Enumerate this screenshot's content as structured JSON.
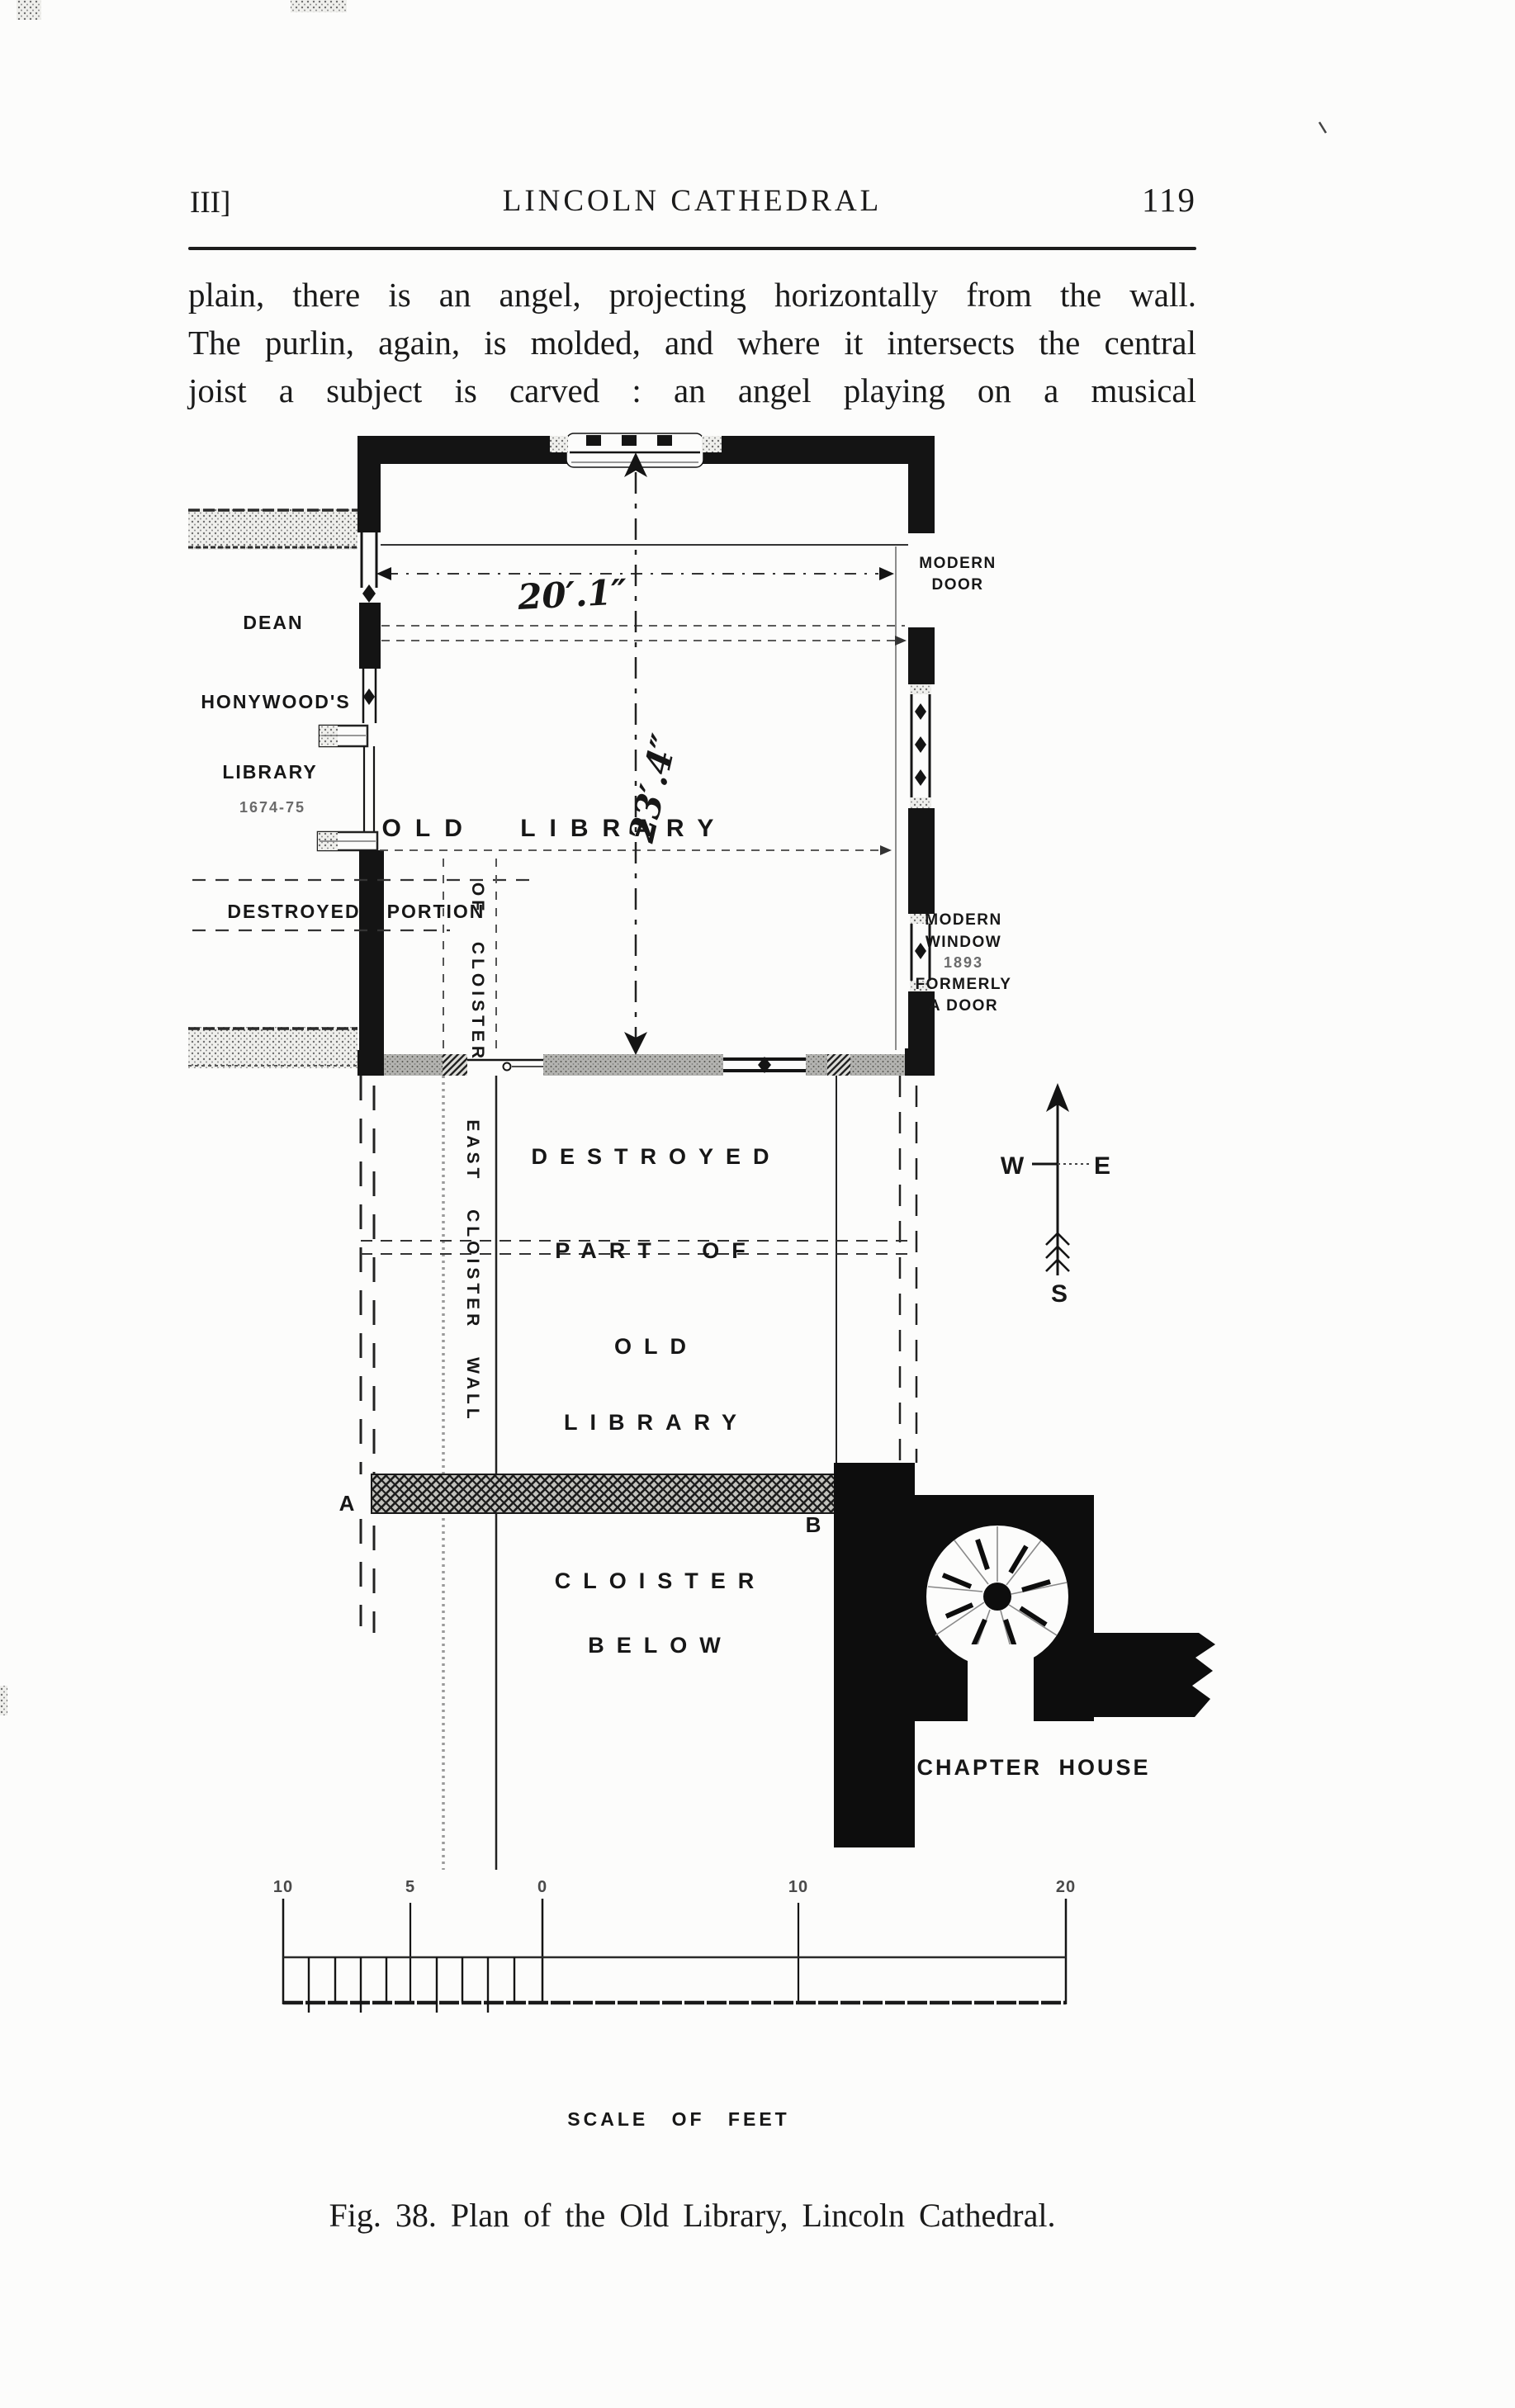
{
  "header": {
    "chapter_marker": "III]",
    "running_title": "LINCOLN CATHEDRAL",
    "page_number": "119"
  },
  "paragraph": {
    "line1": "plain, there is an angel, projecting horizontally from the wall.",
    "line2": "The purlin, again, is molded, and where it intersects the central",
    "line3": "joist a subject is carved : an angel playing on a musical"
  },
  "plan": {
    "west": {
      "dean": "DEAN",
      "honywoods": "HONYWOOD'S",
      "library": "LIBRARY",
      "years": "1674-75"
    },
    "destroyed_portion": {
      "word1": "DESTROYED",
      "word2": "PORTION"
    },
    "vertical": {
      "of_cloister": "OF CLOISTER",
      "east_cloister_wall": "EAST CLOISTER WALL"
    },
    "rooms": {
      "old_library": "OLD LIBRARY",
      "destroyed1": "DESTROYED",
      "destroyed2": "PART OF",
      "destroyed3": "OLD",
      "destroyed4": "LIBRARY",
      "cloister1": "CLOISTER",
      "cloister2": "BELOW",
      "chapter_house": "CHAPTER HOUSE"
    },
    "east": {
      "door1": "MODERN",
      "door2": "DOOR",
      "win1": "MODERN",
      "win2": "WINDOW",
      "win3": "1893",
      "win4": "FORMERLY",
      "win5": "A DOOR"
    },
    "dims": {
      "width": "20′.1″",
      "depth": "23′.4″"
    },
    "markers": {
      "a": "A",
      "b": "B"
    },
    "compass": {
      "west": "W",
      "east": "E",
      "south": "S"
    },
    "scale": {
      "t0": "10",
      "t1": "5",
      "t2": "0",
      "t3": "10",
      "t4": "20",
      "label": "SCALE OF FEET"
    }
  },
  "caption": "Fig. 38.  Plan of the Old Library, Lincoln Cathedral.",
  "colors": {
    "ink": "#161616",
    "paper": "#fcfcfb",
    "gray": "#8f8f8f"
  }
}
